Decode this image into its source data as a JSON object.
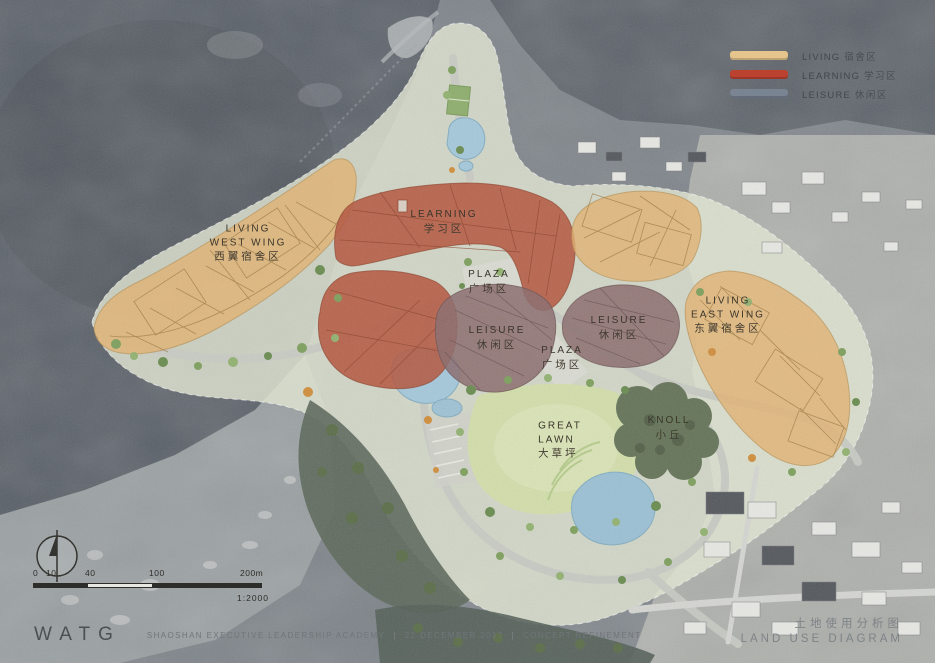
{
  "diagram": {
    "title_cn": "土地使用分析图",
    "title_en": "LAND USE DIAGRAM"
  },
  "legend": {
    "items": [
      {
        "name": "living",
        "label_en": "LIVING",
        "label_cn": "宿舍区",
        "color": "#ecca8e"
      },
      {
        "name": "learning",
        "label_en": "LEARNING",
        "label_cn": "学习区",
        "color": "#c1402d"
      },
      {
        "name": "leisure",
        "label_en": "LEISURE",
        "label_cn": "休闲区",
        "color": "#7b8695"
      }
    ]
  },
  "map_labels": {
    "living_west_wing": {
      "en1": "LIVING",
      "en2": "WEST WING",
      "cn": "西翼宿舍区"
    },
    "learning": {
      "en1": "LEARNING",
      "cn": "学习区"
    },
    "plaza_north": {
      "en1": "PLAZA",
      "cn": "广场区"
    },
    "leisure_central": {
      "en1": "LEISURE",
      "cn": "休闲区"
    },
    "plaza_south": {
      "en1": "PLAZA",
      "cn": "广场区"
    },
    "leisure_east": {
      "en1": "LEISURE",
      "cn": "休闲区"
    },
    "living_east_wing": {
      "en1": "LIVING",
      "en2": "EAST WING",
      "cn": "东翼宿舍区"
    },
    "great_lawn": {
      "en1": "GREAT",
      "en2": "LAWN",
      "cn": "大草坪"
    },
    "knoll": {
      "en1": "KNOLL",
      "cn": "小丘"
    }
  },
  "scale_bar": {
    "ticks": [
      "0",
      "10",
      "40",
      "100",
      "200m"
    ],
    "ratio": "1:2000"
  },
  "footer": {
    "logo": "WATG",
    "project": "SHAOSHAN EXECUTIVE LEADERSHIP ACADEMY",
    "date": "22 DECEMBER 2017",
    "phase": "CONCEPT REFINEMENT",
    "divider": "|"
  },
  "zone_colors": {
    "living": "#e2b271",
    "learning": "#b4573f",
    "leisure": "#8b6c6e",
    "lawn": "#d2ddab",
    "water": "#a3c6d8",
    "knoll": "#66755a"
  }
}
